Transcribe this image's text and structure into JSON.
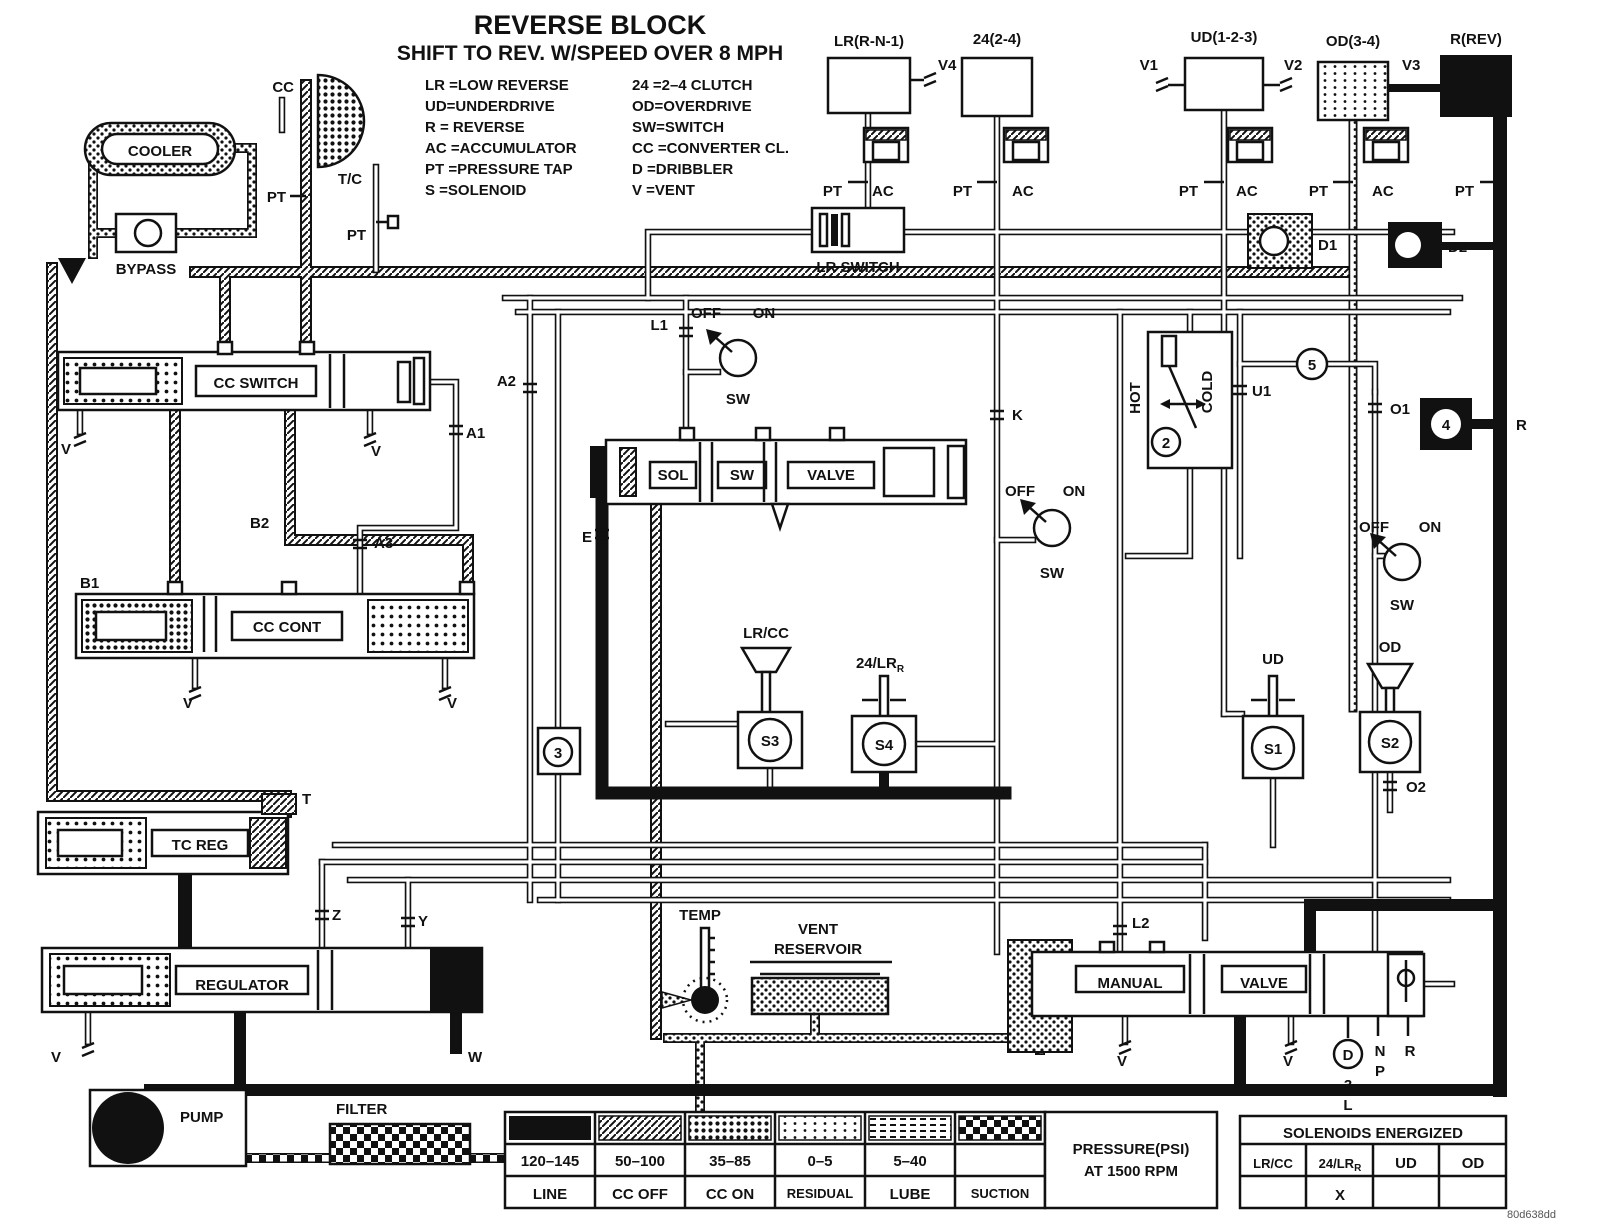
{
  "title": {
    "main": "REVERSE BLOCK",
    "sub": "SHIFT TO REV. W/SPEED OVER 8 MPH"
  },
  "abbrev": {
    "col1": [
      "LR =LOW REVERSE",
      "UD=UNDERDRIVE",
      "R  = REVERSE",
      "AC =ACCUMULATOR",
      "PT =PRESSURE TAP",
      "S  =SOLENOID"
    ],
    "col2": [
      "24 =2–4 CLUTCH",
      "OD=OVERDRIVE",
      "SW=SWITCH",
      "CC =CONVERTER CL.",
      "D  =DRIBBLER",
      "V  =VENT"
    ]
  },
  "circuits": {
    "lr": "LR(R-N-1)",
    "c24": "24(2-4)",
    "ud": "UD(1-2-3)",
    "od": "OD(3-4)",
    "rev": "R(REV)",
    "v1": "V1",
    "v2": "V2",
    "v3": "V3",
    "v4": "V4"
  },
  "labels": {
    "pt": "PT",
    "ac": "AC",
    "d1": "D1",
    "d2": "D2",
    "v": "V",
    "cc": "CC",
    "tc": "T/C",
    "cooler": "COOLER",
    "bypass": "BYPASS",
    "lr_switch": "LR SWITCH",
    "cc_switch": "CC SWITCH",
    "cc_cont": "CC CONT",
    "a1": "A1",
    "a2": "A2",
    "a3": "A3",
    "b1": "B1",
    "b2": "B2",
    "l1": "L1",
    "l2": "L2",
    "e": "E",
    "k": "K",
    "u1": "U1",
    "o1": "O1",
    "o2": "O2",
    "t": "T",
    "z": "Z",
    "y": "Y",
    "w": "W",
    "hot": "HOT",
    "cold": "COLD",
    "off": "OFF",
    "on": "ON",
    "sw": "SW",
    "sol": "SOL",
    "valve": "VALVE",
    "manual": "MANUAL",
    "ud": "UD",
    "od": "OD",
    "s1": "S1",
    "s2": "S2",
    "s3": "S3",
    "s4": "S4",
    "lrcc": "LR/CC",
    "lr24": "24/LR",
    "lr24sub": "R",
    "n2": "2",
    "n3": "3",
    "n4": "4",
    "n5": "5",
    "tc_reg": "TC REG",
    "regulator": "REGULATOR",
    "pump": "PUMP",
    "filter": "FILTER",
    "temp": "TEMP",
    "vent1": "VENT",
    "vent2": "RESERVOIR",
    "pos_d": "D",
    "pos_3": "3",
    "pos_l": "L",
    "pos_n": "N",
    "pos_p": "P",
    "pos_r": "R",
    "r": "R"
  },
  "pressure_table": {
    "title1": "PRESSURE(PSI)",
    "title2": "AT 1500 RPM",
    "rows": [
      {
        "range": "120–145",
        "name": "LINE"
      },
      {
        "range": "50–100",
        "name": "CC OFF"
      },
      {
        "range": "35–85",
        "name": "CC ON"
      },
      {
        "range": "0–5",
        "name": "RESIDUAL"
      },
      {
        "range": "5–40",
        "name": "LUBE"
      },
      {
        "range": "",
        "name": "SUCTION"
      }
    ]
  },
  "solenoid_table": {
    "title": "SOLENOIDS ENERGIZED",
    "col1": "LR/CC",
    "col2": "24/LR",
    "col2sub": "R",
    "col3": "UD",
    "col4": "OD",
    "val1": "",
    "val2": "X",
    "val3": "",
    "val4": ""
  },
  "watermark": "80d638dd"
}
